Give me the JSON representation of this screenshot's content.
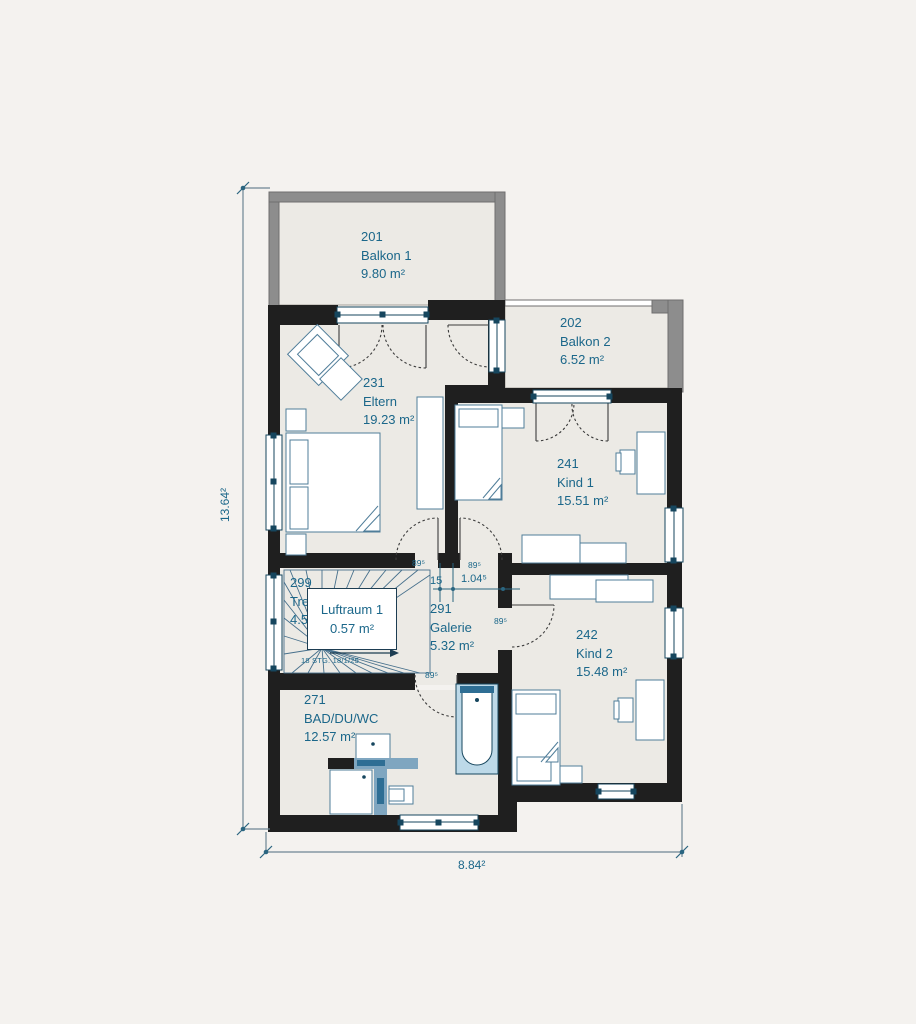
{
  "plan": {
    "rooms": {
      "balkon1": {
        "number": "201",
        "name": "Balkon 1",
        "area": "9.80 m²"
      },
      "balkon2": {
        "number": "202",
        "name": "Balkon 2",
        "area": "6.52 m²"
      },
      "eltern": {
        "number": "231",
        "name": "Eltern",
        "area": "19.23 m²"
      },
      "kind1": {
        "number": "241",
        "name": "Kind 1",
        "area": "15.51 m²"
      },
      "treppe": {
        "number": "299",
        "name": "Treppe",
        "area": "4.53 m²"
      },
      "luftraum": {
        "name": "Luftraum 1",
        "area": "0.57 m²"
      },
      "galerie": {
        "number": "291",
        "name": "Galerie",
        "area": "5.32 m²"
      },
      "kind2": {
        "number": "242",
        "name": "Kind 2",
        "area": "15.48 m²"
      },
      "bad": {
        "number": "271",
        "name": "BAD/DU/WC",
        "area": "12.57 m²"
      }
    },
    "stairs_note": "18 STG. 18/1/25",
    "dimensions": {
      "total_height": "13.64²",
      "total_width": "8.84²",
      "passage": {
        "wall_left": "15",
        "clear": "1.04⁵",
        "wall_right": "15"
      },
      "door_widths": [
        "89⁵",
        "89⁵",
        "89⁵",
        "89⁵"
      ]
    },
    "colors": {
      "wall": "#1f1f1f",
      "floor": "#eceae5",
      "background": "#f4f2ef",
      "railing": "#8d8d8d",
      "text": "#1b678a",
      "window_frame": "#16465e",
      "furniture": "#4f7d99",
      "partition": "#7fa6c0"
    }
  }
}
